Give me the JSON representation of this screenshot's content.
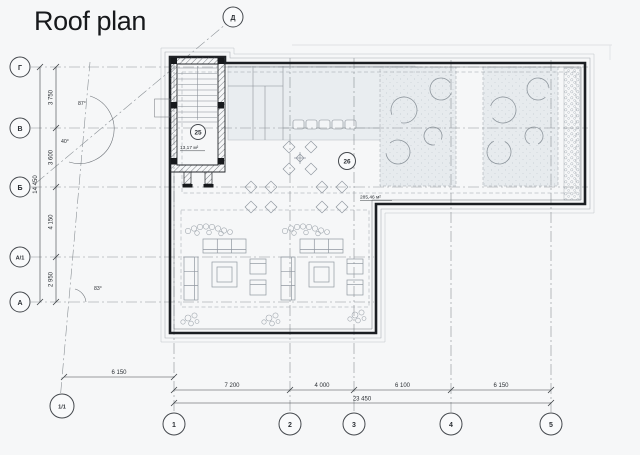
{
  "title": "Roof plan",
  "grid": {
    "rows": [
      {
        "label": "Г"
      },
      {
        "label": "В"
      },
      {
        "label": "Б"
      },
      {
        "label": "А/1"
      },
      {
        "label": "А"
      }
    ],
    "cols": [
      {
        "label": "1"
      },
      {
        "label": "2"
      },
      {
        "label": "3"
      },
      {
        "label": "4"
      },
      {
        "label": "5"
      }
    ],
    "aux_top": {
      "label": "Д"
    },
    "aux_corner": {
      "label": "1/1"
    }
  },
  "dimensions": {
    "left": {
      "segments": [
        "3 750",
        "3 600",
        "4 150",
        "2 950"
      ],
      "total": "14 450"
    },
    "bottom": {
      "offset": "6 150",
      "segments": [
        "7 200",
        "4 000",
        "6 100",
        "6 150"
      ],
      "total": "23 450"
    }
  },
  "angles": {
    "top": "87°",
    "middle": "40°",
    "bottom": "83°"
  },
  "rooms": {
    "stairwell": {
      "number": "25",
      "area": "13,17 м²"
    },
    "terrace": {
      "number": "26",
      "area": "285,46 м²"
    }
  },
  "colors": {
    "wall": "#1b1e22",
    "canopy_fill": "#e9edf0",
    "planting_fill": "#e7ebee",
    "grid_line": "#8b9196",
    "paper": "#f6f7f8"
  }
}
